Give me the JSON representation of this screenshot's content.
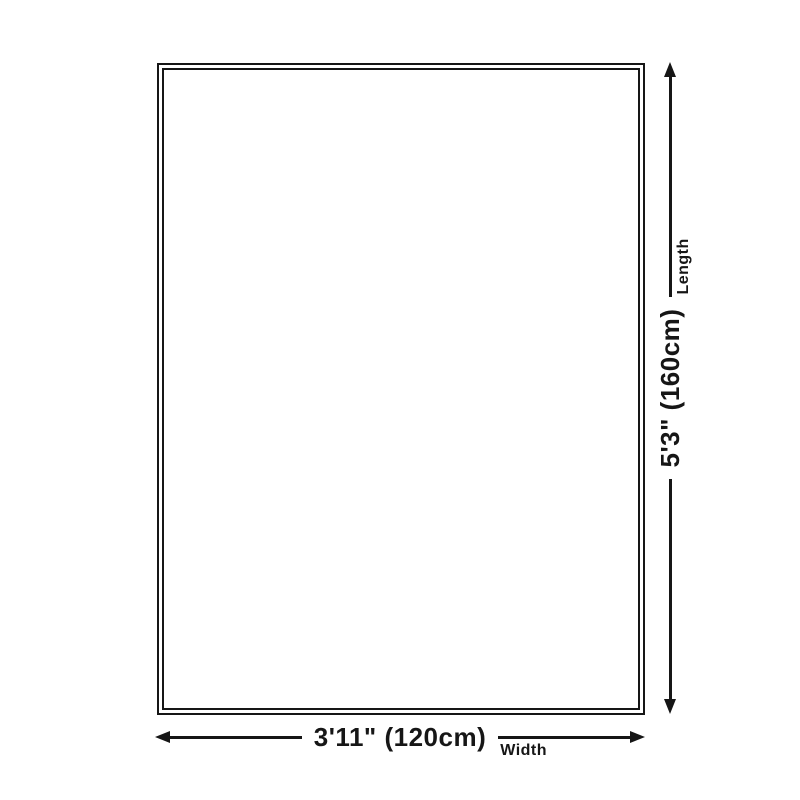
{
  "diagram": {
    "background_color": "#ffffff",
    "line_color": "#161616",
    "shape": "rectangle-double-border",
    "length": {
      "value": "5'3\" (160cm)",
      "label": "Length"
    },
    "width": {
      "value": "3'11\" (120cm)",
      "label": "Width"
    }
  }
}
